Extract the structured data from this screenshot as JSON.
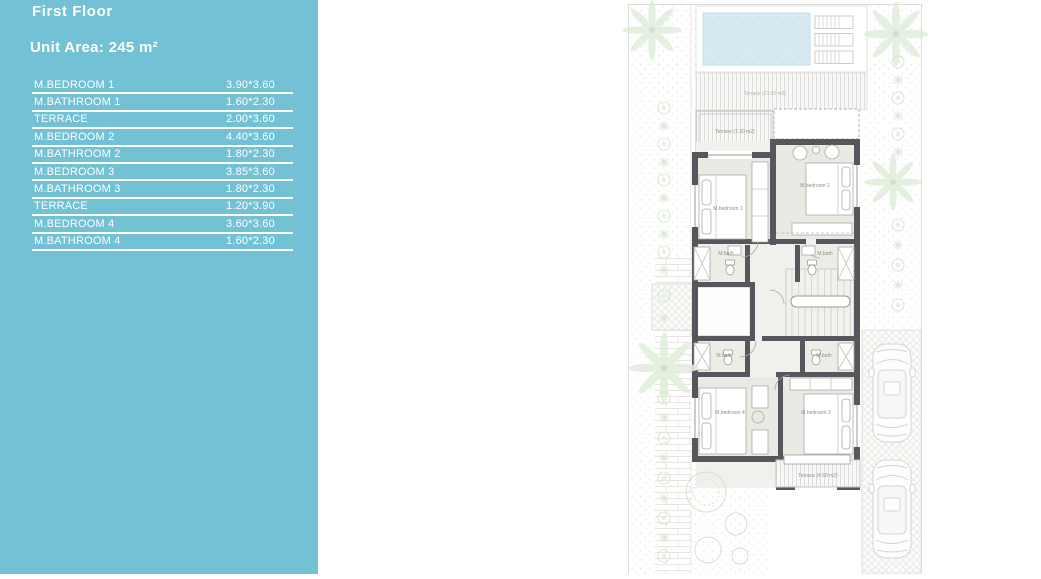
{
  "sidebar": {
    "title": "First Floor",
    "unit_area": "Unit Area: 245 m²",
    "accent_color": "#72c1d4",
    "rooms": [
      {
        "label": "M.BEDROOM 1",
        "size": "3.90*3.60"
      },
      {
        "label": "M.BATHROOM 1",
        "size": "1.60*2.30"
      },
      {
        "label": "TERRACE",
        "size": "2.00*3.60"
      },
      {
        "label": "M.BEDROOM 2",
        "size": "4.40*3.60"
      },
      {
        "label": "M.BATHROOM 2",
        "size": "1.80*2.30"
      },
      {
        "label": "M.BEDROOM 3",
        "size": "3.85*3.60"
      },
      {
        "label": "M.BATHROOM 3",
        "size": "1.80*2.30"
      },
      {
        "label": "TERRACE",
        "size": "1.20*3.90"
      },
      {
        "label": "M.BEDROOM 4",
        "size": "3.60*3.60"
      },
      {
        "label": "M.BATHROOM 4",
        "size": "1.60*2.30"
      }
    ]
  },
  "plan": {
    "labels": {
      "terrace_top": "Terrace (23.00 m2)",
      "terrace_left": "Terrace (7.20 m2)",
      "terrace_bottom": "Terrace (4.68 m2)",
      "bedroom1": "M.bedroom 1",
      "bedroom2": "M.bedroom 2",
      "bedroom3": "M.bedroom 3",
      "bedroom4": "M.bedroom 4",
      "bath": "M.bath"
    },
    "colors": {
      "wall": "#57565c",
      "room_fill": "#eae9e3",
      "pool": "#d7eaf1",
      "plant": "#d7e8d3",
      "label_text": "#8f8f8c"
    }
  }
}
